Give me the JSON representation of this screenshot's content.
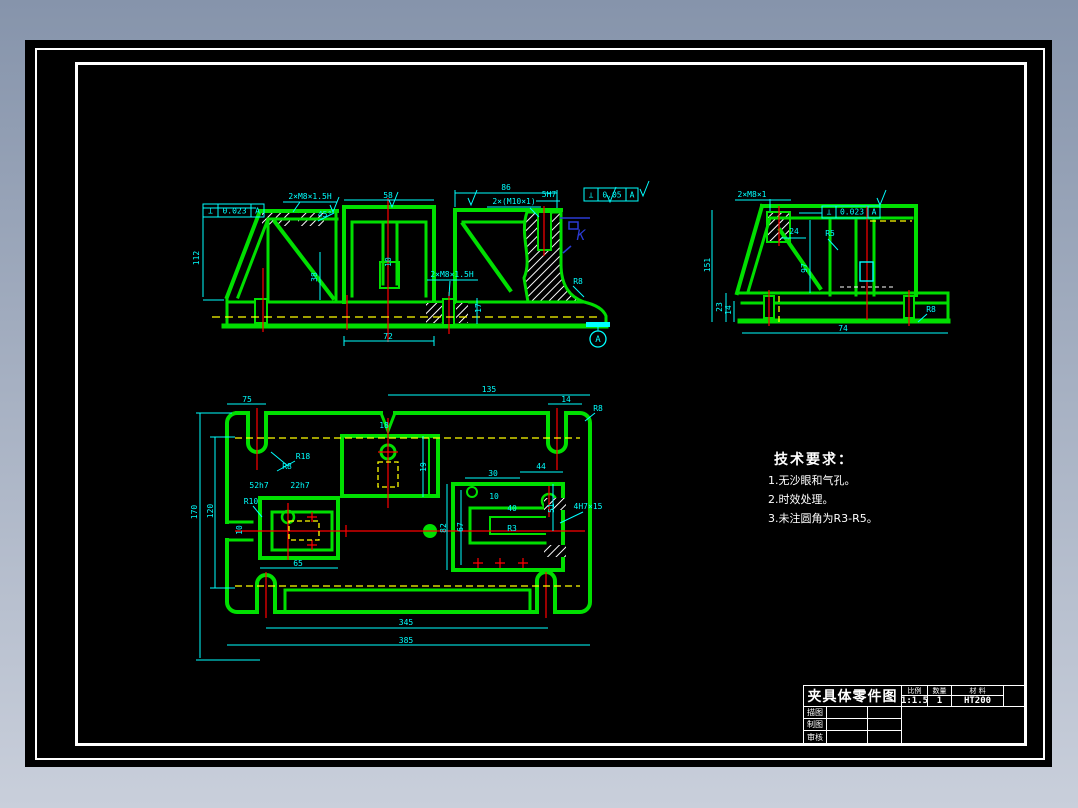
{
  "colors": {
    "background_top": "#8694ab",
    "background_bottom": "#c9cfdb",
    "drawing_bg": "#000000",
    "outline_green": "#00df00",
    "dimension_cyan": "#00ffff",
    "centerline_red": "#ff0000",
    "hidden_yellow": "#ffff00",
    "hatch_white": "#ffffff",
    "view_label_blue": "#2a3bd6"
  },
  "tech_requirements": {
    "title": "技术要求：",
    "items": [
      "1.无沙眼和气孔。",
      "2.时效处理。",
      "3.未注圆角为R3-R5。"
    ]
  },
  "title_block": {
    "title": "夹具体零件图",
    "headers": {
      "scale": "比例",
      "quantity": "数量",
      "material": "材 料"
    },
    "values": {
      "scale": "1:1.5",
      "quantity": "1",
      "material": "HT200"
    },
    "rows": [
      {
        "label": "描图"
      },
      {
        "label": "制图"
      },
      {
        "label": "审核"
      }
    ]
  },
  "datum_label": "A",
  "tolerance_frames": [
    {
      "x": 203,
      "y": 204,
      "h": 13,
      "cells": [
        {
          "t": "⊥",
          "w": 15
        },
        {
          "t": "0.023",
          "w": 33
        },
        {
          "t": "A",
          "w": 13
        }
      ]
    },
    {
      "x": 584,
      "y": 188,
      "h": 13,
      "cells": [
        {
          "t": "⊥",
          "w": 14
        },
        {
          "t": "0.05",
          "w": 28
        },
        {
          "t": "A",
          "w": 12
        }
      ]
    },
    {
      "x": 822,
      "y": 206,
      "h": 12,
      "cells": [
        {
          "t": "⊥",
          "w": 14
        },
        {
          "t": "0.023",
          "w": 32
        },
        {
          "t": "A",
          "w": 12
        }
      ]
    }
  ],
  "cad_labels": [
    {
      "t": "2×M8×1.5H",
      "x": 310,
      "y": 199
    },
    {
      "t": "58",
      "x": 388,
      "y": 198
    },
    {
      "t": "86",
      "x": 506,
      "y": 190
    },
    {
      "t": "2×(M10×1)",
      "x": 514,
      "y": 204
    },
    {
      "t": "5H7",
      "x": 549,
      "y": 197
    },
    {
      "t": "45°",
      "x": 325,
      "y": 217
    },
    {
      "t": "112",
      "x": 199,
      "y": 258,
      "r": -90
    },
    {
      "t": "38",
      "x": 317,
      "y": 277,
      "r": -90
    },
    {
      "t": "10",
      "x": 391,
      "y": 262,
      "r": -90
    },
    {
      "t": "17",
      "x": 481,
      "y": 308,
      "r": -90
    },
    {
      "t": "2×M8×1.5H",
      "x": 452,
      "y": 277
    },
    {
      "t": "R8",
      "x": 578,
      "y": 284
    },
    {
      "t": "72",
      "x": 388,
      "y": 339
    },
    {
      "t": "K",
      "x": 581,
      "y": 240,
      "c": "#2a3bd6",
      "s": 14,
      "i": true
    },
    {
      "t": "A",
      "x": 598,
      "y": 342,
      "s": 9
    },
    {
      "t": "2×M8×1",
      "x": 752,
      "y": 197
    },
    {
      "t": "24",
      "x": 794,
      "y": 234
    },
    {
      "t": "R5",
      "x": 830,
      "y": 236
    },
    {
      "t": "151",
      "x": 710,
      "y": 265,
      "r": -90
    },
    {
      "t": "97",
      "x": 807,
      "y": 268,
      "r": -90
    },
    {
      "t": "23",
      "x": 722,
      "y": 307,
      "r": -90
    },
    {
      "t": "14",
      "x": 731,
      "y": 310,
      "r": -90
    },
    {
      "t": "74",
      "x": 843,
      "y": 331
    },
    {
      "t": "R8",
      "x": 931,
      "y": 312
    },
    {
      "t": "75",
      "x": 247,
      "y": 402
    },
    {
      "t": "135",
      "x": 489,
      "y": 392
    },
    {
      "t": "14",
      "x": 566,
      "y": 402
    },
    {
      "t": "R8",
      "x": 598,
      "y": 411
    },
    {
      "t": "R18",
      "x": 303,
      "y": 459
    },
    {
      "t": "R8",
      "x": 287,
      "y": 469
    },
    {
      "t": "52h7",
      "x": 259,
      "y": 488
    },
    {
      "t": "22h7",
      "x": 300,
      "y": 488
    },
    {
      "t": "R10",
      "x": 251,
      "y": 504
    },
    {
      "t": "170",
      "x": 197,
      "y": 512,
      "r": -90
    },
    {
      "t": "120",
      "x": 213,
      "y": 511,
      "r": -90
    },
    {
      "t": "10",
      "x": 242,
      "y": 530,
      "r": -90
    },
    {
      "t": "65",
      "x": 298,
      "y": 566
    },
    {
      "t": "345",
      "x": 406,
      "y": 625
    },
    {
      "t": "385",
      "x": 406,
      "y": 643
    },
    {
      "t": "18",
      "x": 384,
      "y": 428
    },
    {
      "t": "19",
      "x": 426,
      "y": 467,
      "r": -90
    },
    {
      "t": "30",
      "x": 493,
      "y": 476
    },
    {
      "t": "44",
      "x": 541,
      "y": 469
    },
    {
      "t": "10",
      "x": 494,
      "y": 499
    },
    {
      "t": "40",
      "x": 512,
      "y": 511
    },
    {
      "t": "67",
      "x": 463,
      "y": 527,
      "r": -90
    },
    {
      "t": "82",
      "x": 446,
      "y": 528,
      "r": -90
    },
    {
      "t": "51",
      "x": 554,
      "y": 508,
      "r": -90
    },
    {
      "t": "R3",
      "x": 512,
      "y": 531
    },
    {
      "t": "4H7×15",
      "x": 588,
      "y": 509
    }
  ]
}
